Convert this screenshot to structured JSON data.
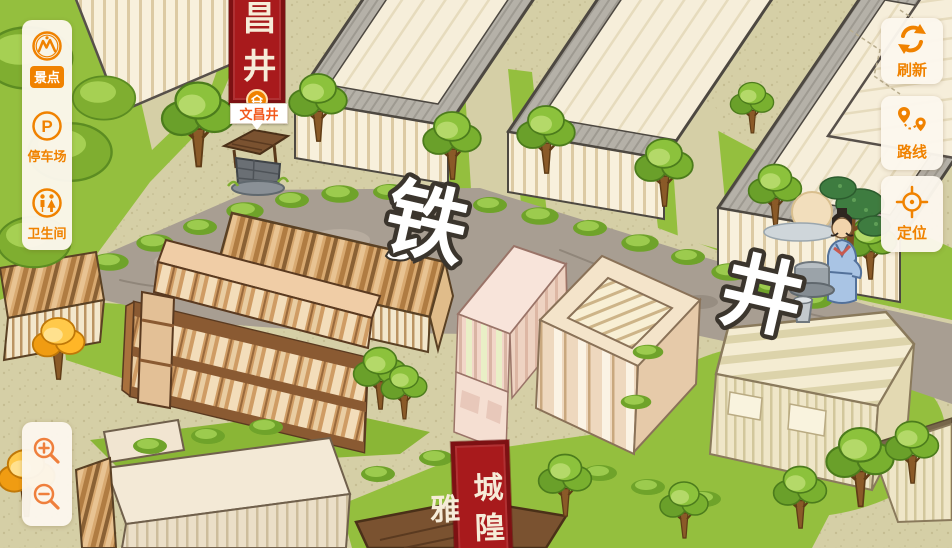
{
  "sidebar": {
    "items": [
      {
        "id": "scenic",
        "label": "景点",
        "icon": "scenic-spot-icon",
        "active": true
      },
      {
        "id": "parking",
        "label": "停车场",
        "icon": "parking-icon",
        "active": false
      },
      {
        "id": "restroom",
        "label": "卫生间",
        "icon": "restroom-icon",
        "active": false
      }
    ]
  },
  "zoom_controls": {
    "buttons": [
      {
        "id": "zoom-in",
        "icon": "magnifier-plus-icon"
      },
      {
        "id": "zoom-out",
        "icon": "magnifier-minus-icon"
      }
    ]
  },
  "action_buttons": [
    {
      "id": "refresh",
      "label": "刷新",
      "icon": "refresh-arrows-icon"
    },
    {
      "id": "route",
      "label": "路线",
      "icon": "route-pins-icon"
    },
    {
      "id": "locate",
      "label": "定位",
      "icon": "crosshair-icon"
    }
  ],
  "map": {
    "street_characters": [
      {
        "char": "铁"
      },
      {
        "char": "井"
      }
    ],
    "banners": {
      "top_text": "文昌井",
      "bottom_text": "城隍雅"
    },
    "marker": {
      "label": "文昌井",
      "icon": "well-icon"
    },
    "illustrations": [
      "scholar-at-well",
      "old-well",
      "white-bird"
    ]
  },
  "colors": {
    "accent_orange": "#f08200",
    "panel_cream": "#fcf7ee",
    "banner_red": "#a81a1c",
    "marker_label_text": "#f2591e",
    "road_gray": "#a89e92",
    "grass_green": "#94bf3e",
    "path_khaki": "#d5cfa6",
    "roof_gray": "#b5b1a8",
    "wood_tan": "#d8a970",
    "building_pink": "#f4e0d4"
  }
}
